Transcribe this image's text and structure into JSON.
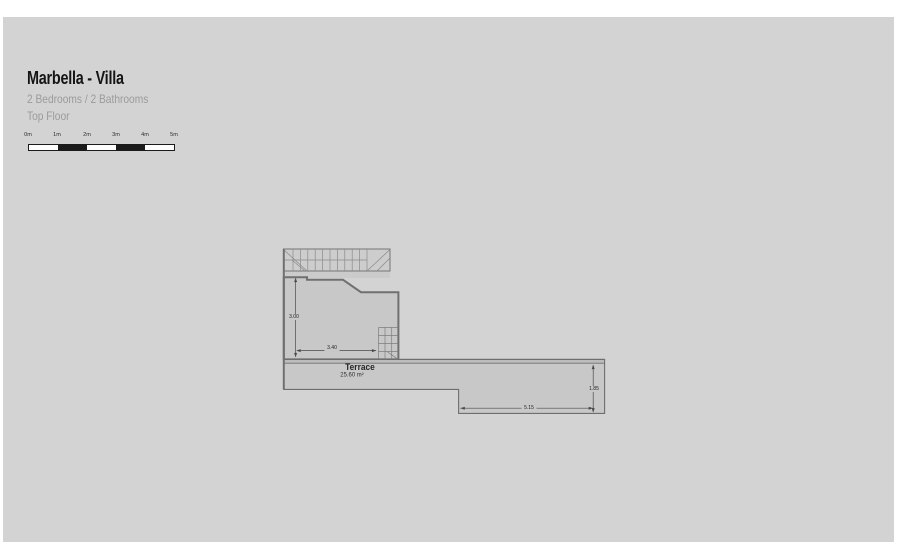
{
  "header": {
    "title": "Marbella - Villa",
    "subtitle": "2 Bedrooms / 2 Bathrooms",
    "floor": "Top Floor"
  },
  "scale_bar": {
    "labels": [
      "0m",
      "1m",
      "2m",
      "3m",
      "4m",
      "5m"
    ],
    "segments": [
      "white",
      "black",
      "white",
      "black",
      "white"
    ]
  },
  "plan": {
    "room": {
      "name": "Terrace",
      "area": "25.60 m²"
    },
    "dims": {
      "room_height": "3.00",
      "room_width": "3.40",
      "terrace_width": "5.15",
      "terrace_height": "1.85"
    }
  },
  "colors": {
    "page_bg": "#ffffff",
    "canvas_bg": "#d3d3d3",
    "plan_fill": "#c8c8c8",
    "stair_fill": "#cdcdcd",
    "wall_line": "#707070",
    "dim_line": "#4a4a4a",
    "title_text": "#151515",
    "subtitle_text": "#9b9b9b",
    "scale_black": "#1b1b1b"
  }
}
